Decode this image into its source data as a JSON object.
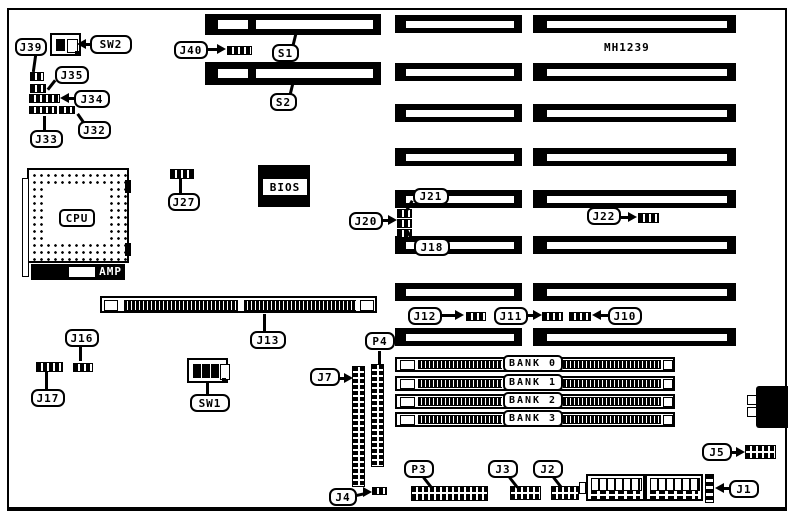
{
  "diagram": {
    "part_number": "MH1239",
    "cpu_label": "CPU",
    "cpu_bar_label": "AMP",
    "bios_label": "BIOS",
    "callouts": {
      "j39": "J39",
      "sw2": "SW2",
      "j35": "J35",
      "j34": "J34",
      "j32": "J32",
      "j33": "J33",
      "j40": "J40",
      "s1": "S1",
      "s2": "S2",
      "j27": "J27",
      "j21": "J21",
      "j20": "J20",
      "j18": "J18",
      "j22": "J22",
      "j12": "J12",
      "j11": "J11",
      "j10": "J10",
      "j13": "J13",
      "j16": "J16",
      "j17": "J17",
      "sw1": "SW1",
      "p4": "P4",
      "j7": "J7",
      "p3": "P3",
      "j3": "J3",
      "j2": "J2",
      "j4": "J4",
      "j5": "J5",
      "j1": "J1"
    },
    "memory_banks": [
      "BANK 0",
      "BANK 1",
      "BANK 2",
      "BANK 3"
    ]
  }
}
